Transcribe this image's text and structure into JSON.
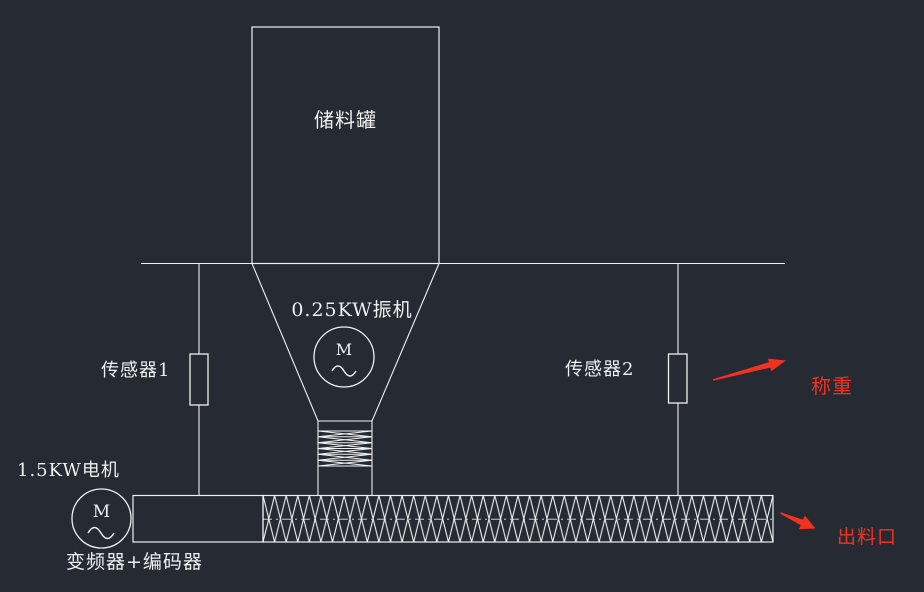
{
  "diagram": {
    "title_hint": "material weighing and screw-feeder system schematic",
    "storage_tank": {
      "label": "储料罐"
    },
    "vibrator": {
      "label": "0.25KW振机",
      "symbol": "M"
    },
    "sensor1": {
      "label": "传感器1"
    },
    "sensor2": {
      "label": "传感器2"
    },
    "weighing_annotation": {
      "label": "称重",
      "color": "#f23120"
    },
    "drive_motor": {
      "label": "1.5KW电机",
      "symbol": "M",
      "sub_label": "变频器+编码器"
    },
    "outlet_annotation": {
      "label": "出料口",
      "color": "#f23120"
    }
  },
  "colors": {
    "background": "#252a33",
    "line": "#eef0f2",
    "annotation_red": "#f23120"
  }
}
